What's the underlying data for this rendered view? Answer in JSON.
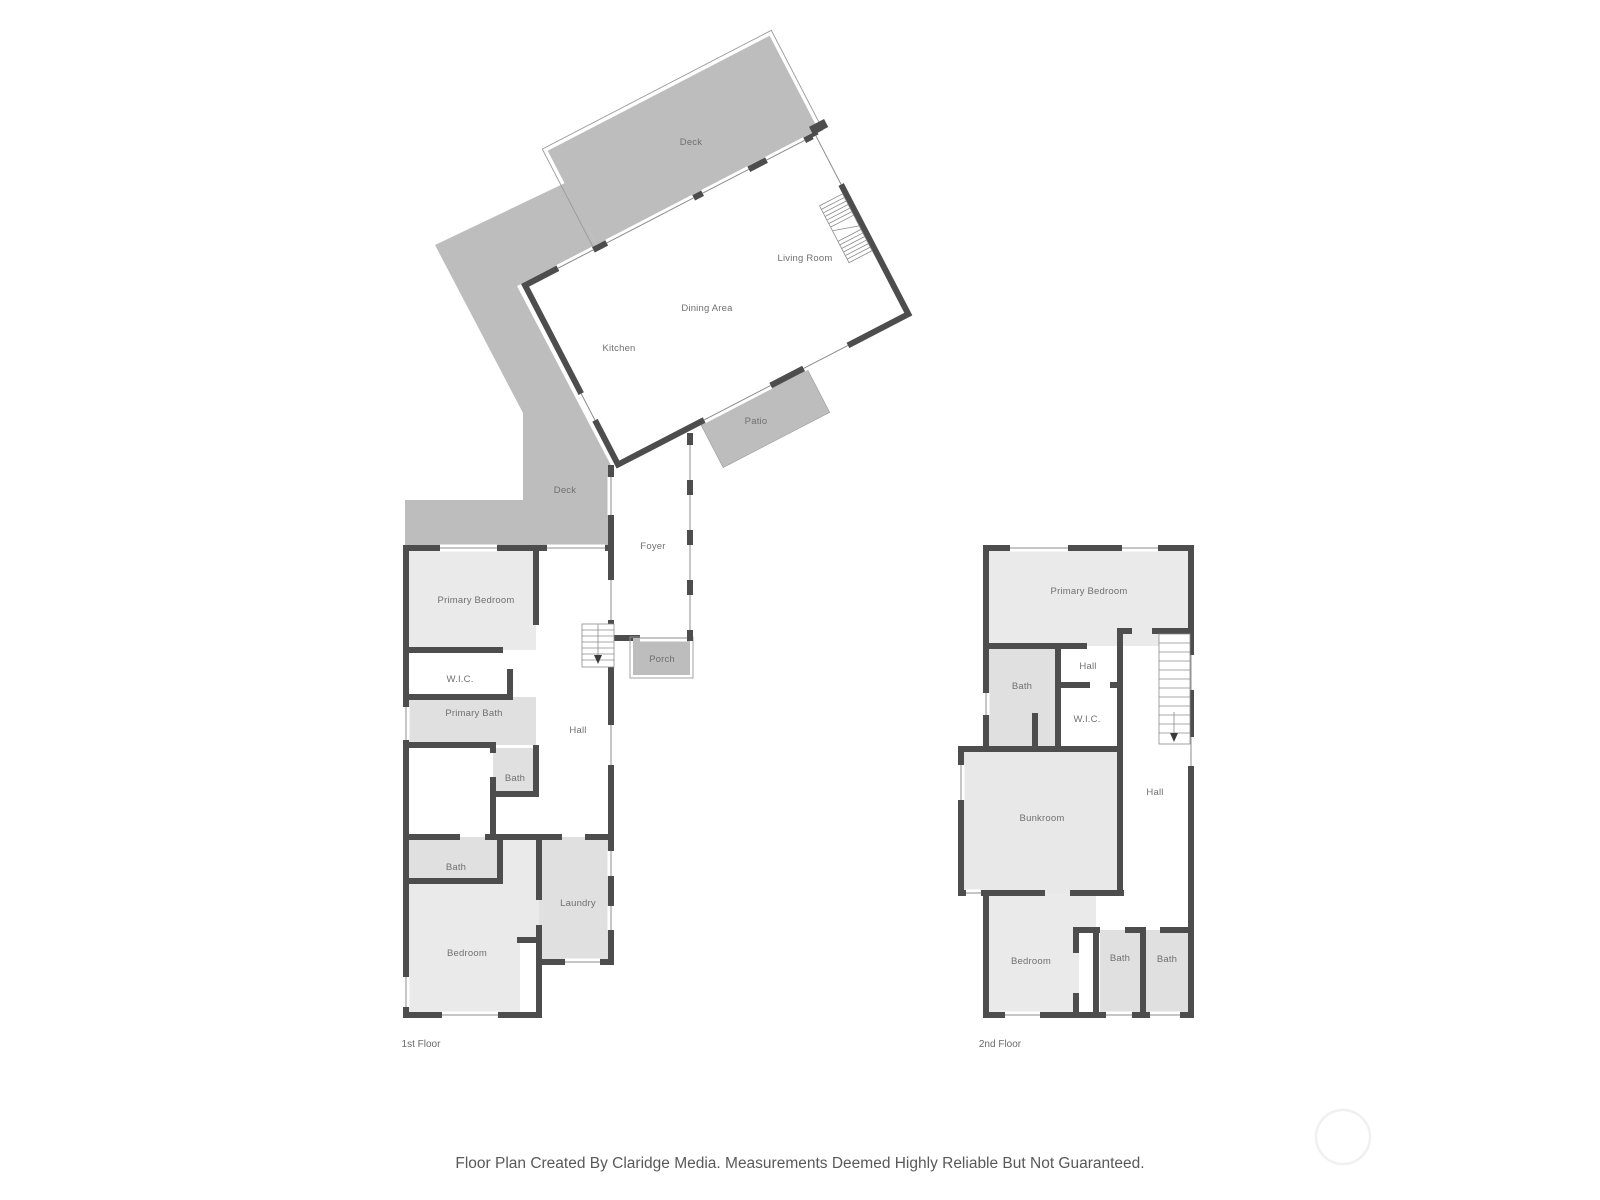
{
  "caption": "Floor Plan Created By Claridge Media. Measurements Deemed Highly Reliable But Not Guaranteed.",
  "colors": {
    "wall": "#4d4d4d",
    "outdoor_gray": "#bdbdbd",
    "room_gray": "#eaeaea",
    "bath_gray": "#e0e0e0",
    "label_gray": "#707070"
  },
  "upper": {
    "deck": "Deck",
    "living_room": "Living Room",
    "dining_area": "Dining Area",
    "kitchen": "Kitchen",
    "patio": "Patio",
    "deck_lower": "Deck",
    "foyer": "Foyer",
    "porch": "Porch"
  },
  "floor1": {
    "label": "1st Floor",
    "primary_bedroom": "Primary Bedroom",
    "wic": "W.I.C.",
    "primary_bath": "Primary Bath",
    "hall": "Hall",
    "bath_upper": "Bath",
    "bath_lower": "Bath",
    "bedroom": "Bedroom",
    "laundry": "Laundry"
  },
  "floor2": {
    "label": "2nd Floor",
    "primary_bedroom": "Primary Bedroom",
    "hall_small": "Hall",
    "bath": "Bath",
    "wic": "W.I.C.",
    "bunkroom": "Bunkroom",
    "hall_main": "Hall",
    "bedroom": "Bedroom",
    "bath_left": "Bath",
    "bath_right": "Bath"
  }
}
